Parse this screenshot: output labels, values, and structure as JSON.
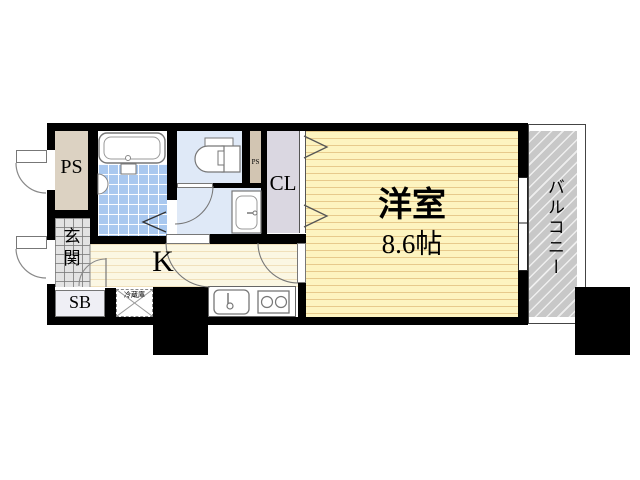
{
  "plan": {
    "title": "1K apartment floor plan",
    "rooms": {
      "ps_shaft": {
        "label": "PS"
      },
      "ps_small": {
        "label": "PS"
      },
      "entrance": {
        "label": "玄関"
      },
      "shoe_box": {
        "label": "SB"
      },
      "kitchen": {
        "label": "K"
      },
      "closet": {
        "label": "CL"
      },
      "main_room": {
        "label": "洋室",
        "size": "8.6帖"
      },
      "balcony": {
        "label": "バルコニー"
      }
    },
    "fixtures": {
      "refrigerator": {
        "label": "冷蔵庫"
      },
      "bathtub": {
        "name": "bathtub"
      },
      "shower_unit": {
        "name": "shower-unit"
      },
      "bath_counter": {
        "name": "bath-counter"
      },
      "toilet": {
        "name": "toilet"
      },
      "washbasin": {
        "name": "washbasin"
      },
      "kitchen_sink": {
        "name": "kitchen-sink"
      },
      "stove_two_burner": {
        "name": "two-burner-stove"
      }
    },
    "colors": {
      "wall": "#000000",
      "main_room_floor": "#fdf4c0",
      "kitchen_floor": "#fbf7e3",
      "bath_tile": "#a9c8ef",
      "sanitary_floor": "#dfe9f7",
      "shaft": "#dcd2c2",
      "closet": "#dad7e1",
      "entrance_tile": "#e3e3e3",
      "balcony": "#c8c8c8"
    }
  }
}
